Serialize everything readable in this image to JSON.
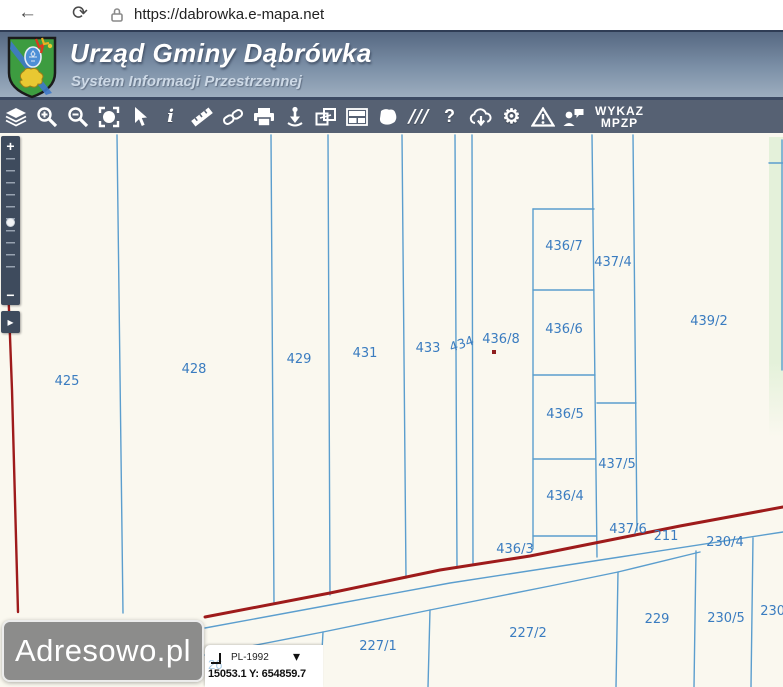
{
  "browser": {
    "url": "https://dabrowka.e-mapa.net"
  },
  "header": {
    "title": "Urząd Gminy Dąbrówka",
    "subtitle": "System Informacji Przestrzennej"
  },
  "toolbar": {
    "icons": [
      {
        "name": "layers"
      },
      {
        "name": "zoom-in"
      },
      {
        "name": "zoom-out"
      },
      {
        "name": "full-extent"
      },
      {
        "name": "cursor"
      },
      {
        "name": "info",
        "glyph": "i"
      },
      {
        "name": "measure"
      },
      {
        "name": "link"
      },
      {
        "name": "print"
      },
      {
        "name": "locate"
      },
      {
        "name": "copy-view"
      },
      {
        "name": "layout"
      },
      {
        "name": "draw-polygon"
      },
      {
        "name": "hatch",
        "glyph": "///"
      },
      {
        "name": "help",
        "glyph": "?"
      },
      {
        "name": "cloud-download"
      },
      {
        "name": "settings",
        "glyph": "⚙"
      },
      {
        "name": "warning"
      },
      {
        "name": "contact"
      }
    ],
    "wykaz_line1": "WYKAZ",
    "wykaz_line2": "MPZP"
  },
  "map": {
    "colors": {
      "background": "#faf8ef",
      "parcel_line": "#5b9ece",
      "label": "#3a7cc0",
      "boundary_red": "#9e1b1b",
      "green_area": "#e4f1da"
    },
    "parcel_labels": [
      {
        "text": "425",
        "x": 67,
        "y": 252
      },
      {
        "text": "428",
        "x": 194,
        "y": 240
      },
      {
        "text": "429",
        "x": 299,
        "y": 230
      },
      {
        "text": "431",
        "x": 365,
        "y": 224
      },
      {
        "text": "433",
        "x": 428,
        "y": 219
      },
      {
        "text": "434",
        "x": 463,
        "y": 215,
        "angle": -18
      },
      {
        "text": "436/8",
        "x": 501,
        "y": 210
      },
      {
        "text": "436/7",
        "x": 564,
        "y": 117
      },
      {
        "text": "437/4",
        "x": 613,
        "y": 133
      },
      {
        "text": "436/6",
        "x": 564,
        "y": 200
      },
      {
        "text": "439/2",
        "x": 709,
        "y": 192
      },
      {
        "text": "436/5",
        "x": 565,
        "y": 285
      },
      {
        "text": "437/5",
        "x": 617,
        "y": 335
      },
      {
        "text": "436/4",
        "x": 565,
        "y": 367
      },
      {
        "text": "436/3",
        "x": 515,
        "y": 420
      },
      {
        "text": "437/6",
        "x": 628,
        "y": 400
      },
      {
        "text": "211",
        "x": 666,
        "y": 407
      },
      {
        "text": "230/4",
        "x": 725,
        "y": 413
      },
      {
        "text": "227/1",
        "x": 378,
        "y": 517
      },
      {
        "text": "227/2",
        "x": 528,
        "y": 504
      },
      {
        "text": "229",
        "x": 657,
        "y": 490
      },
      {
        "text": "230/5",
        "x": 726,
        "y": 489
      },
      {
        "text": "230/3",
        "x": 779,
        "y": 482
      }
    ],
    "point_marker": {
      "x": 494,
      "y": 219
    }
  },
  "zoom_slider": {
    "plus": "+",
    "minus": "−",
    "arrow": "▸"
  },
  "watermark": {
    "text": "Adresowo.pl"
  },
  "coords_panel": {
    "crs": "PL-1992",
    "chevron": "▾",
    "coords": "15053.1  Y: 654859.7",
    "partial_label": "26"
  },
  "nav": {
    "back": "←",
    "reload": "⟳"
  }
}
